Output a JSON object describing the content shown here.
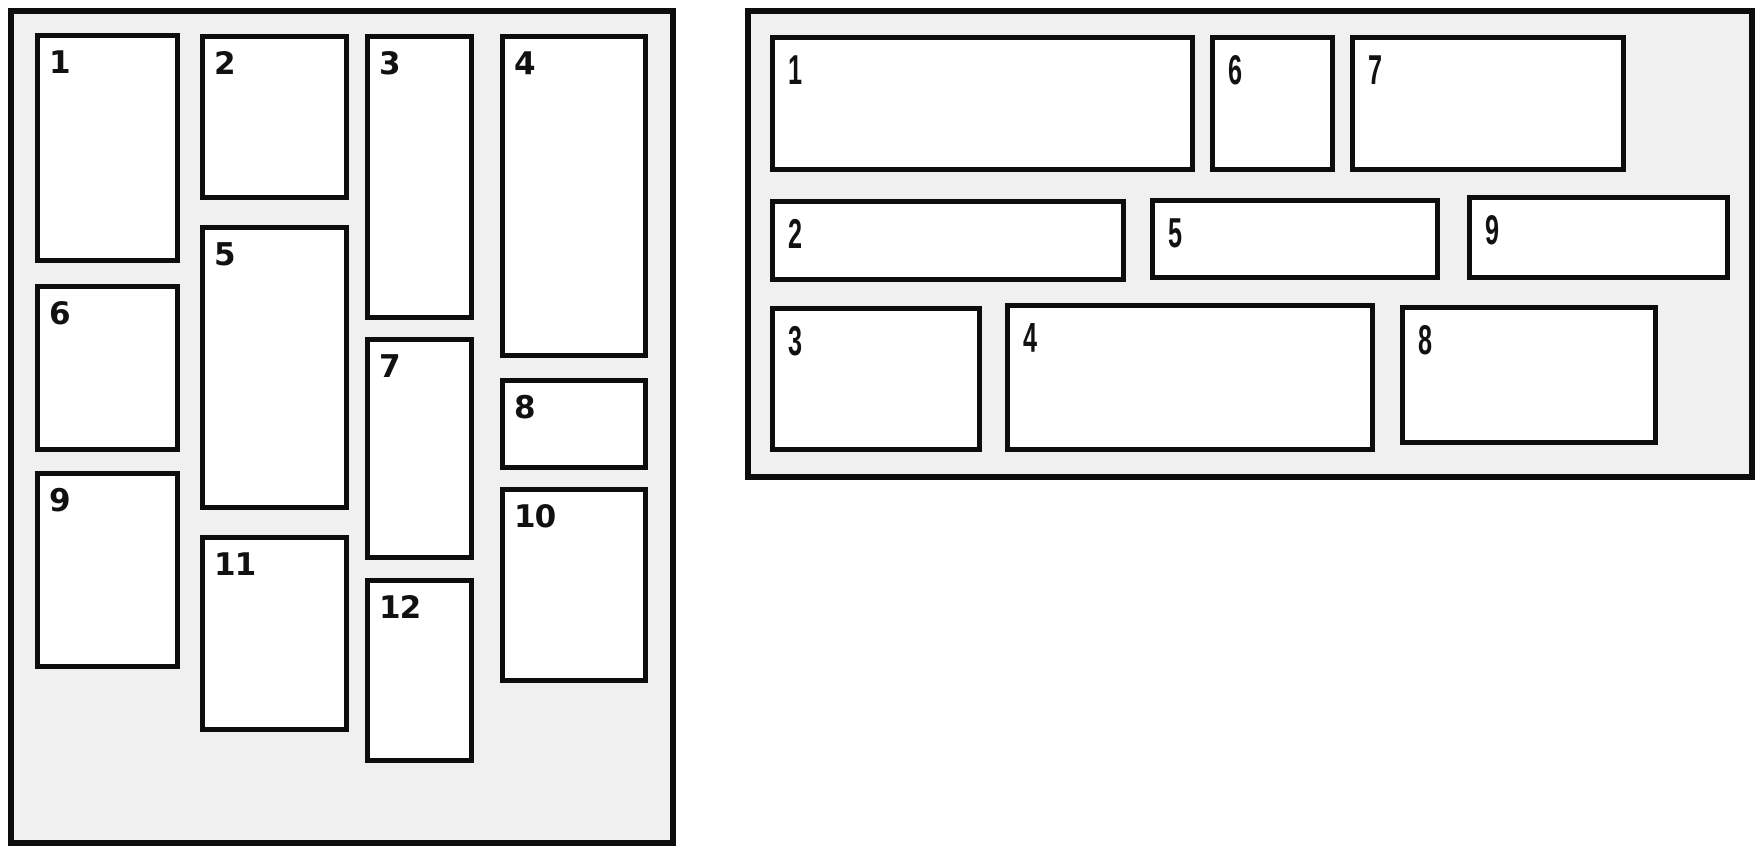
{
  "page": {
    "background": "#ffffff"
  },
  "style": {
    "panel_background": "#f0f0f0",
    "box_background": "#ffffff",
    "border_color": "#0d0d0d",
    "label_color": "#111111"
  },
  "panels": [
    {
      "id": "left-masonry-panel",
      "variant": "columns",
      "x": 8,
      "y": 8,
      "w": 668,
      "h": 838,
      "boxes": [
        {
          "label": "1",
          "x": 35,
          "y": 33,
          "w": 145,
          "h": 230
        },
        {
          "label": "2",
          "x": 200,
          "y": 34,
          "w": 149,
          "h": 166
        },
        {
          "label": "3",
          "x": 365,
          "y": 34,
          "w": 109,
          "h": 286
        },
        {
          "label": "4",
          "x": 500,
          "y": 34,
          "w": 148,
          "h": 324
        },
        {
          "label": "5",
          "x": 200,
          "y": 225,
          "w": 149,
          "h": 285
        },
        {
          "label": "6",
          "x": 35,
          "y": 284,
          "w": 145,
          "h": 168
        },
        {
          "label": "7",
          "x": 365,
          "y": 337,
          "w": 109,
          "h": 223
        },
        {
          "label": "8",
          "x": 500,
          "y": 378,
          "w": 148,
          "h": 92
        },
        {
          "label": "9",
          "x": 35,
          "y": 471,
          "w": 145,
          "h": 198
        },
        {
          "label": "10",
          "x": 500,
          "y": 487,
          "w": 148,
          "h": 196
        },
        {
          "label": "11",
          "x": 200,
          "y": 535,
          "w": 149,
          "h": 197
        },
        {
          "label": "12",
          "x": 365,
          "y": 578,
          "w": 109,
          "h": 185
        }
      ]
    },
    {
      "id": "right-masonry-panel",
      "variant": "rows",
      "x": 745,
      "y": 8,
      "w": 1010,
      "h": 472,
      "boxes": [
        {
          "label": "1",
          "x": 770,
          "y": 35,
          "w": 425,
          "h": 137
        },
        {
          "label": "6",
          "x": 1210,
          "y": 35,
          "w": 125,
          "h": 137
        },
        {
          "label": "7",
          "x": 1350,
          "y": 35,
          "w": 276,
          "h": 137
        },
        {
          "label": "2",
          "x": 770,
          "y": 199,
          "w": 356,
          "h": 83
        },
        {
          "label": "5",
          "x": 1150,
          "y": 198,
          "w": 290,
          "h": 82
        },
        {
          "label": "9",
          "x": 1467,
          "y": 195,
          "w": 263,
          "h": 85
        },
        {
          "label": "3",
          "x": 770,
          "y": 306,
          "w": 212,
          "h": 146
        },
        {
          "label": "4",
          "x": 1005,
          "y": 303,
          "w": 370,
          "h": 149
        },
        {
          "label": "8",
          "x": 1400,
          "y": 305,
          "w": 258,
          "h": 140
        }
      ]
    }
  ]
}
